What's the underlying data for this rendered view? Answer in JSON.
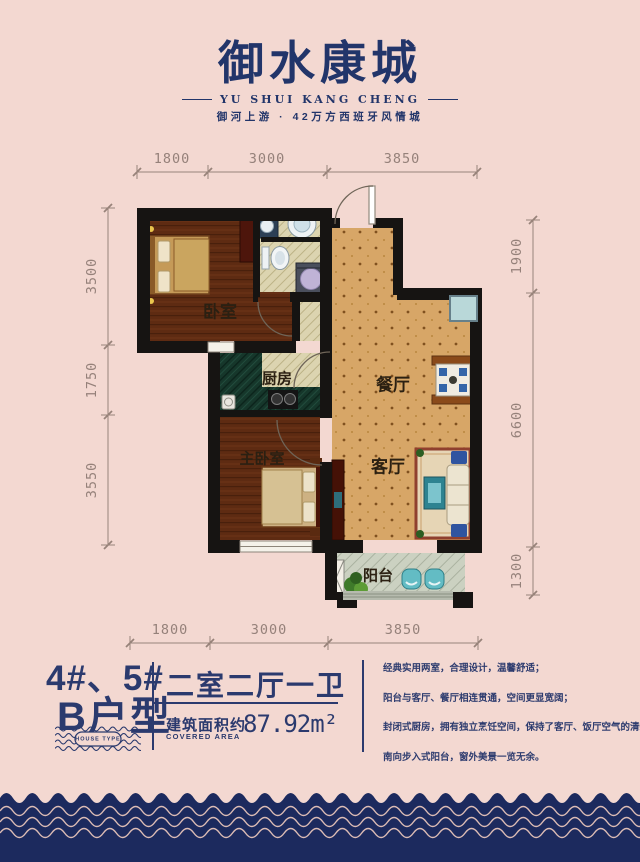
{
  "page": {
    "background": "#f3d8d1",
    "accent_navy": "#24366b",
    "footer_navy": "#1c2a5e",
    "wave_line_pink": "#dcbcb5"
  },
  "logo": {
    "title": "御水康城",
    "subtitle": "YU SHUI KANG CHENG",
    "tagline": "御河上游 · 42万方西班牙风情城"
  },
  "floor_plan": {
    "rooms": {
      "bedroom": "卧室",
      "kitchen": "厨房",
      "dining": "餐厅",
      "living": "客厅",
      "master_bedroom": "主卧室",
      "balcony": "阳台"
    },
    "dimensions": {
      "top": [
        "1800",
        "3000",
        "3850"
      ],
      "bottom": [
        "1800",
        "3000",
        "3850"
      ],
      "left": [
        "3500",
        "1750",
        "3550"
      ],
      "right": [
        "1900",
        "6600",
        "1300"
      ]
    }
  },
  "info": {
    "building_no": "4#、5#",
    "unit_name": "B户型",
    "stamp_text": "HOUSE TYPE",
    "layout": "二室二厅一卫",
    "area_label_cn": "建筑面积约",
    "area_label_en": "COVERED AREA",
    "area_value": "87.92m²",
    "features": [
      "经典实用两室，合理设计，温馨舒适；",
      "阳台与客厅、餐厅相连贯通，空间更显宽阔；",
      "封闭式厨房，拥有独立烹饪空间，保持了客厅、饭厅空气的清新；",
      "南向步入式阳台，窗外美景一览无余。"
    ]
  }
}
